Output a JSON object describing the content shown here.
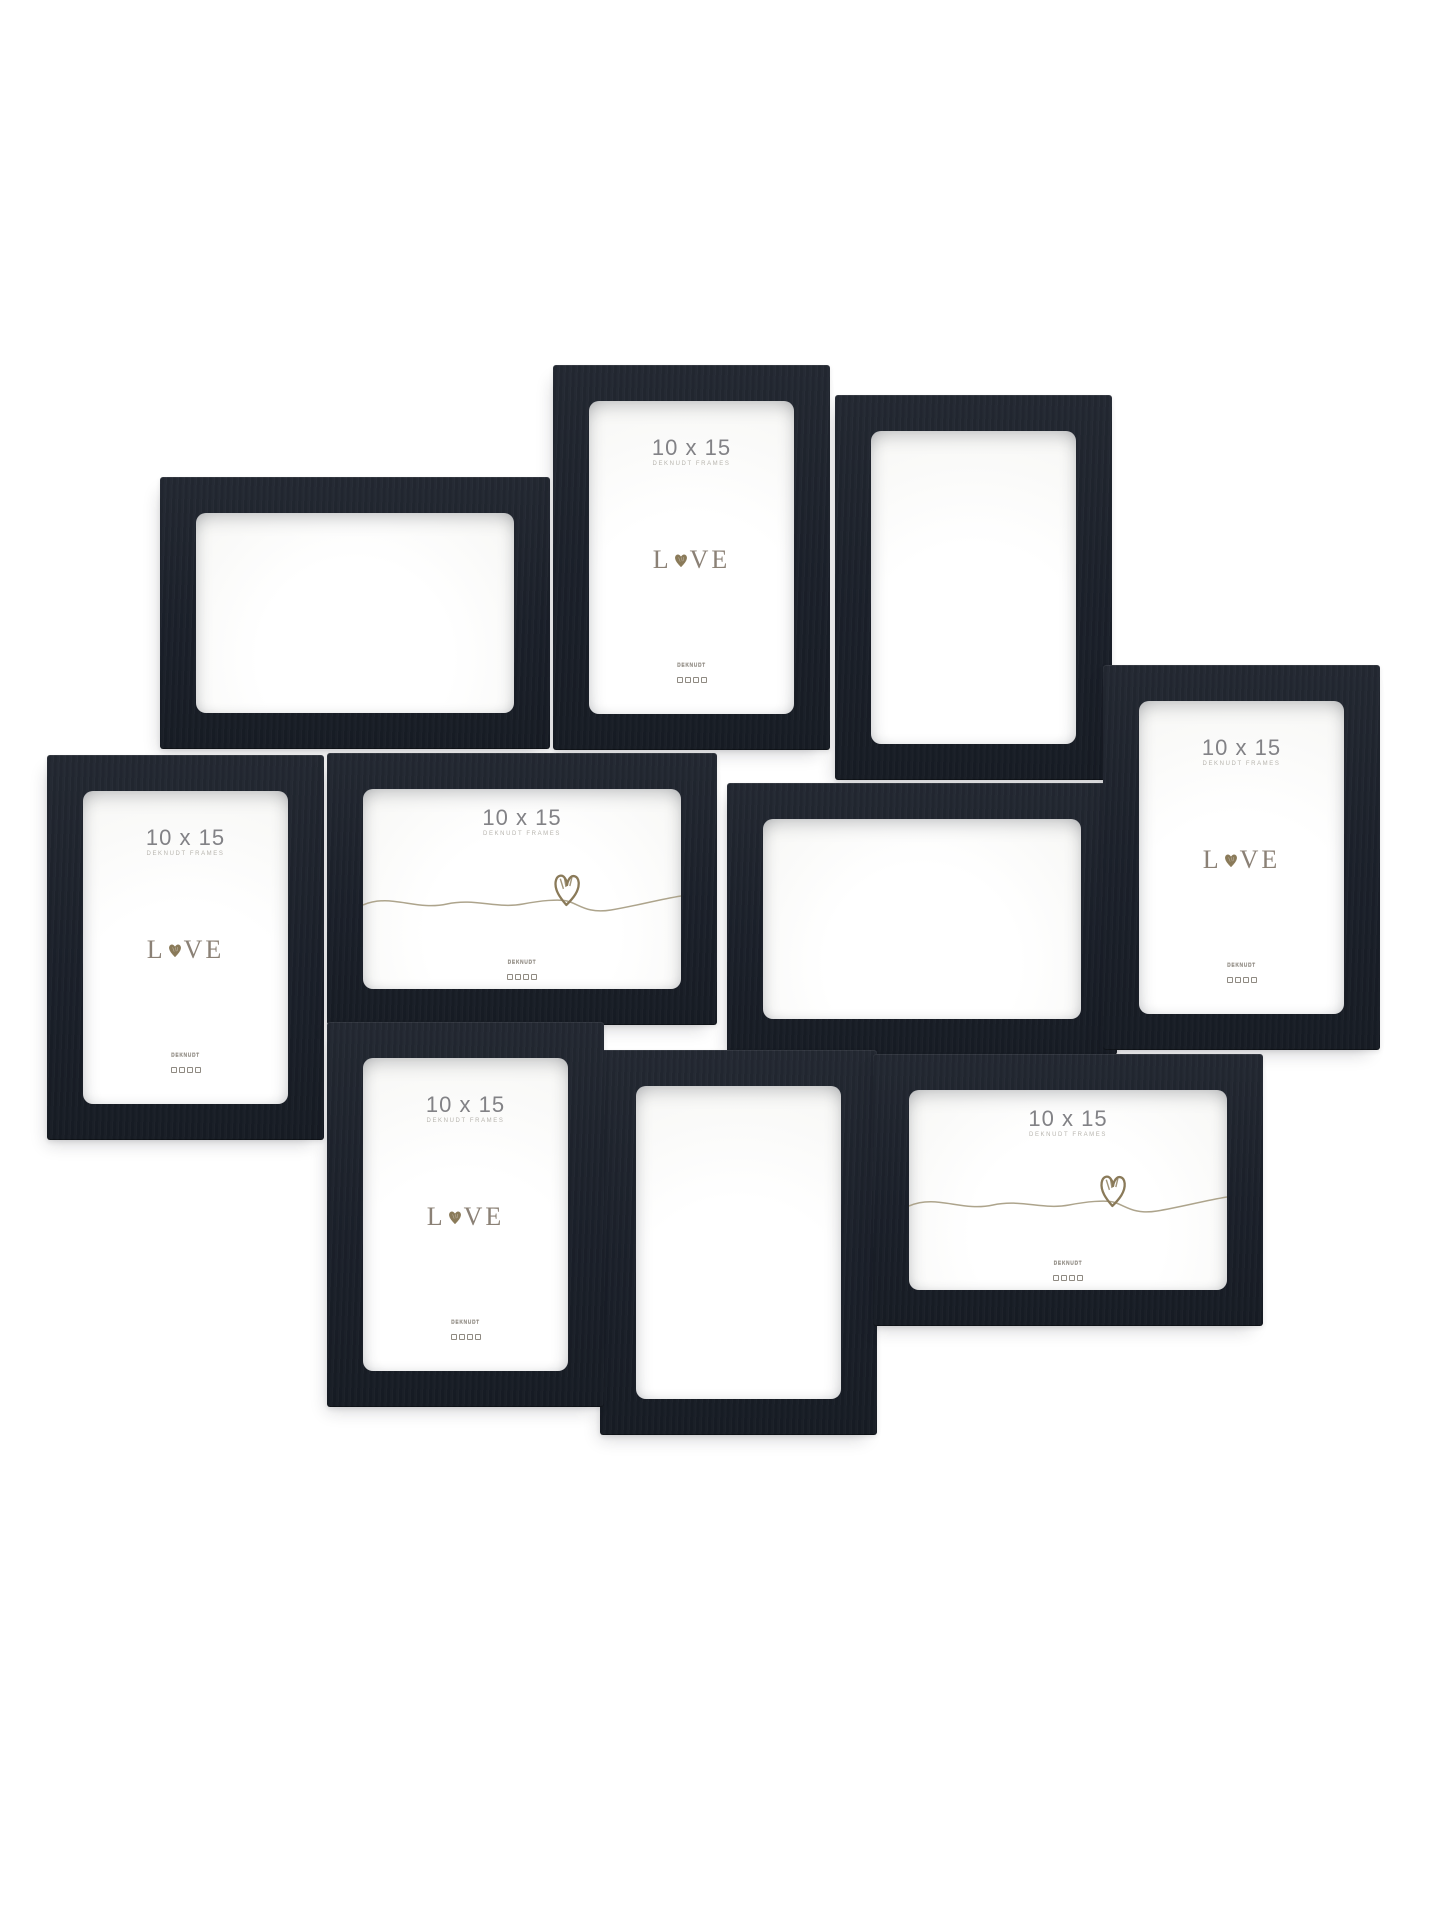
{
  "product": {
    "description": "wall collage of ten black wooden photo frames on a white background",
    "frame_count": 10,
    "frame_color": "#1d222b",
    "background_color": "#ffffff"
  },
  "insert": {
    "size_label": "10 x 15",
    "brand_label": "DEKNUDT FRAMES",
    "love_l": "L",
    "love_ve": "VE",
    "logo_text": "DEKNUDT",
    "text_color": "#828286",
    "brand_text_color": "#b7b4ae",
    "love_text_color": "#8b8176",
    "heart_color": "#8a7a59",
    "line_color": "#a49a80"
  },
  "frames": [
    {
      "id": "1",
      "orientation": "landscape",
      "variant": "empty",
      "x": 160,
      "y": 477,
      "w": 390,
      "h": 272,
      "z": 1
    },
    {
      "id": "2",
      "orientation": "portrait",
      "variant": "love",
      "x": 553,
      "y": 365,
      "w": 277,
      "h": 385,
      "z": 2
    },
    {
      "id": "3",
      "orientation": "portrait",
      "variant": "empty",
      "x": 835,
      "y": 395,
      "w": 277,
      "h": 385,
      "z": 1
    },
    {
      "id": "4",
      "orientation": "portrait",
      "variant": "love",
      "x": 47,
      "y": 755,
      "w": 277,
      "h": 385,
      "z": 2
    },
    {
      "id": "5",
      "orientation": "landscape",
      "variant": "squiggle",
      "x": 327,
      "y": 753,
      "w": 390,
      "h": 272,
      "z": 3
    },
    {
      "id": "6",
      "orientation": "landscape",
      "variant": "empty",
      "x": 727,
      "y": 783,
      "w": 390,
      "h": 272,
      "z": 2
    },
    {
      "id": "7",
      "orientation": "portrait",
      "variant": "love",
      "x": 1103,
      "y": 665,
      "w": 277,
      "h": 385,
      "z": 4
    },
    {
      "id": "8",
      "orientation": "portrait",
      "variant": "love",
      "x": 327,
      "y": 1022,
      "w": 277,
      "h": 385,
      "z": 4
    },
    {
      "id": "9",
      "orientation": "portrait",
      "variant": "empty",
      "x": 600,
      "y": 1050,
      "w": 277,
      "h": 385,
      "z": 3
    },
    {
      "id": "10",
      "orientation": "landscape",
      "variant": "squiggle",
      "x": 873,
      "y": 1054,
      "w": 390,
      "h": 272,
      "z": 4
    }
  ]
}
